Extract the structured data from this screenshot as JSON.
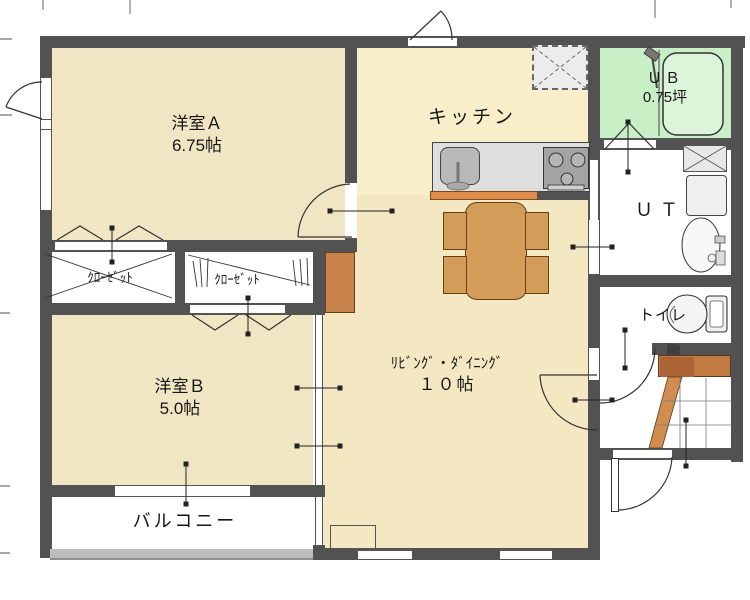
{
  "plan": {
    "type": "japanese-apartment-floor-plan",
    "rooms": {
      "western_a": {
        "label": "洋室Ａ",
        "size": "6.75帖"
      },
      "kitchen": {
        "label": "キッチン"
      },
      "unit_bath": {
        "label": "ＵＢ",
        "size": "0.75坪"
      },
      "utility": {
        "label": "ＵＴ"
      },
      "toilet": {
        "label": "トイレ"
      },
      "closet_left": {
        "label": "ｸﾛｰｾﾞｯﾄ"
      },
      "closet_right": {
        "label": "ｸﾛｰｾﾞｯﾄ"
      },
      "western_b": {
        "label": "洋室Ｂ",
        "size": "5.0帖"
      },
      "living_dining": {
        "label": "ﾘﾋﾞﾝｸﾞ・ﾀﾞｲﾆﾝｸﾞ",
        "size": "１０帖"
      },
      "balcony": {
        "label": "バルコニー"
      }
    },
    "colors": {
      "wall": "#525252",
      "room_floor": "#f1e6c3",
      "living_floor": "#f3e8c1",
      "kitchen_floor": "#f8efca",
      "bath_floor": "#c9efc7",
      "wood_accent": "#d39c58",
      "genkan_step": "#c17a41",
      "counter": "#dedede"
    }
  }
}
